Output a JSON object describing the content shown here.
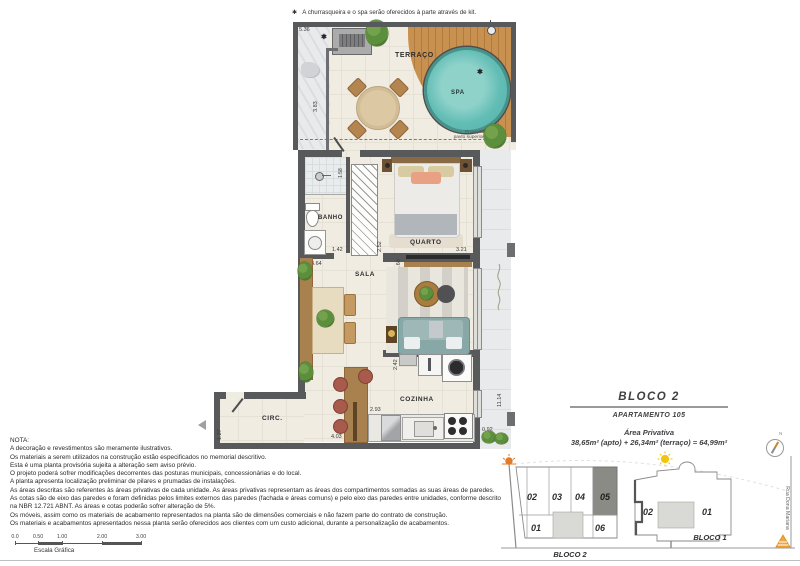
{
  "top_note": {
    "star": "✱",
    "text": "A churrasqueira e o spa serão oferecidos à parte através de kit."
  },
  "plan": {
    "asterisk": "✱",
    "rooms": {
      "terraco": "TERRAÇO",
      "spa": "SPA",
      "banho": "BANHO",
      "quarto": "QUARTO",
      "sala": "SALA",
      "cozinha": "COZINHA",
      "circ": "CIRC."
    },
    "projection": {
      "line1": "Projeção",
      "line2": "pavto superior"
    },
    "dims": {
      "d536": "5.36",
      "d383": "3.83",
      "d158": "1.58",
      "d142": "1.42",
      "d252": "2.52",
      "d321": "3.21",
      "d464": "4.64",
      "d260": "2.60",
      "d242": "2.42",
      "d293": "2.93",
      "d403": "4.03",
      "d092": "0.92",
      "d1114": "11.14",
      "d127": "1.27"
    }
  },
  "info": {
    "block_title": "BLOCO 2",
    "apartment": "APARTAMENTO 105",
    "area_label": "Área Privativa",
    "area_value": "38,65m² (apto) + 26,34m² (terraço) = 64,99m²"
  },
  "compass": {
    "north": "N"
  },
  "site": {
    "bloco2_label": "BLOCO 2",
    "bloco1_label": "BLOCO 1",
    "street": "Rua Dona Mariana",
    "bloco2_units_top": [
      "02",
      "03",
      "04",
      "05"
    ],
    "bloco2_units_bottom": [
      "01",
      "06"
    ],
    "bloco1_units": [
      "02",
      "01"
    ],
    "highlight_unit": "05"
  },
  "nota": {
    "title": "NOTA:",
    "lines": [
      "A decoração e revestimentos são meramente ilustrativos.",
      "Os materiais a serem utilizados na construção estão especificados no memorial descritivo.",
      "Esta é uma planta provisória sujeita a alteração sem aviso prévio.",
      "O projeto poderá sofrer modificações decorrentes das posturas municipais, concessionárias e do local.",
      "A planta apresenta localização preliminar de pilares e prumadas de instalações.",
      "As áreas descritas são referentes às áreas privativas de cada unidade. As áreas privativas representam as áreas dos compartimentos somadas as suas áreas de paredes.",
      "As cotas são de eixo das paredes e foram definidas pelos limites externos das paredes (fachada e áreas comuns) e pelo eixo das paredes entre unidades, conforme descrito",
      "na NBR 12.721 ABNT. As áreas e cotas poderão sofrer alteração de 5%.",
      "Os móveis, assim como os materiais de acabamento representados na planta são de dimensões comerciais e não fazem parte do contrato de construção.",
      "Os materiais e acabamentos apresentados nessa planta serão oferecidos aos clientes com um custo adicional, durante a personalização de acabamentos."
    ]
  },
  "scale": {
    "labels": [
      "0.0",
      "0.50",
      "1.00",
      "2.00",
      "3.00"
    ],
    "caption": "Escala Gráfica"
  },
  "colors": {
    "wall": "#58595b",
    "spa_water": "#62bdb5",
    "deck_wood": "#c08a4e",
    "sofa": "#87a8a6",
    "stool": "#a85a4c",
    "unit_highlight": "#8b8b85",
    "sun_yellow": "#f1c40f",
    "sun_orange": "#e67e22",
    "triangle_orange": "#f0a63c"
  }
}
